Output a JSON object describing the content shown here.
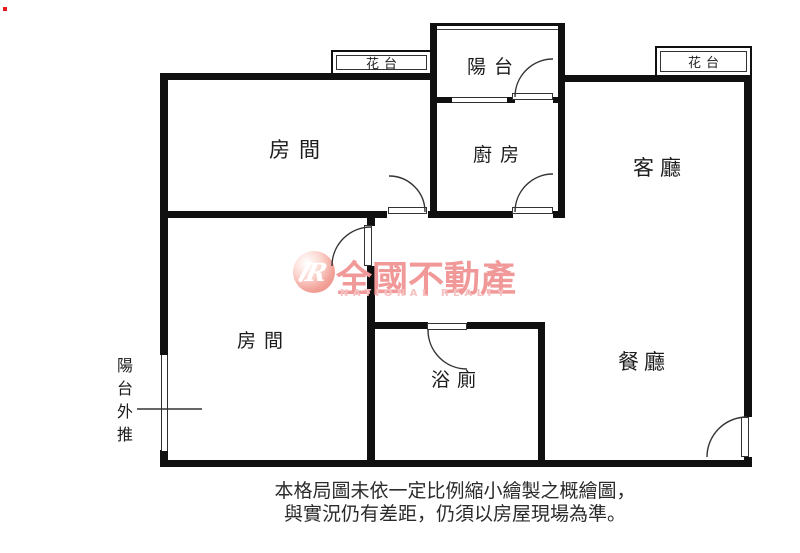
{
  "floorplan": {
    "rooms": {
      "bedroom_top": "房間",
      "bedroom_left": "房間",
      "kitchen": "廚房",
      "living_room": "客廳",
      "dining_room": "餐廳",
      "bathroom": "浴廁",
      "balcony": "陽台",
      "flower_bed_left": "花台",
      "flower_bed_right": "花台",
      "balcony_extension": "陽台外推"
    },
    "disclaimer": {
      "line1": "本格局圖未依一定比例縮小繪製之概繪圖，",
      "line2": "與實況仍有差距，仍須以房屋現場為準。"
    }
  },
  "watermark": {
    "logo_monogram": "R",
    "brand": "全國不動產",
    "brand_en": "NATIONAL REALTY"
  },
  "colors": {
    "wall": "#101010",
    "line": "#333333",
    "brand_pink": "#f19898",
    "brand_light_pink": "#f6c2c2",
    "red_dot": "#e31b1b",
    "background": "#ffffff"
  }
}
